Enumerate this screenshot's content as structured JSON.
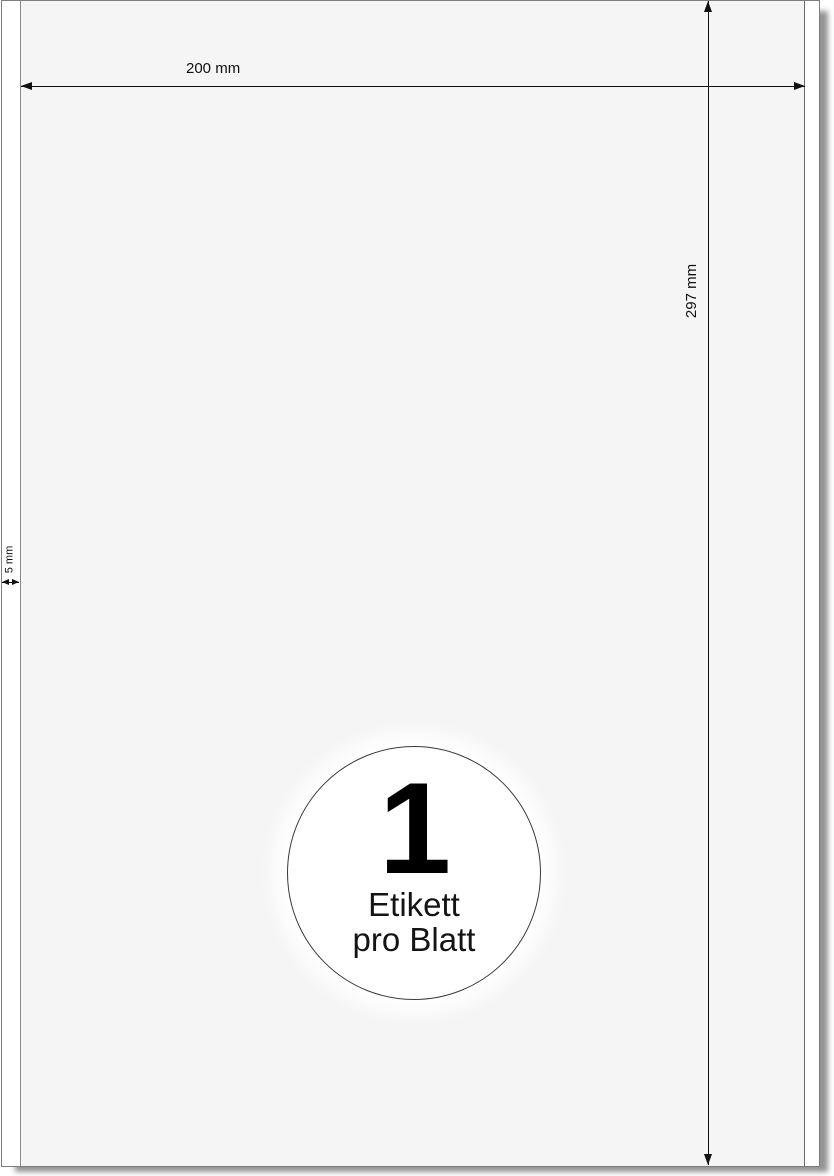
{
  "diagram": {
    "dimensions": {
      "width": "200 mm",
      "height": "297 mm",
      "margin_left": "5 mm"
    },
    "badge": {
      "count": "1",
      "caption_line1": "Etikett",
      "caption_line2": "pro Blatt"
    },
    "colors": {
      "sheet_fill": "#ffffff",
      "label_fill": "#f5f5f5",
      "dimension_line": "#111111",
      "sheet_border": "#7d7d7d",
      "label_border": "#8a8a8a",
      "text": "#111111"
    }
  }
}
